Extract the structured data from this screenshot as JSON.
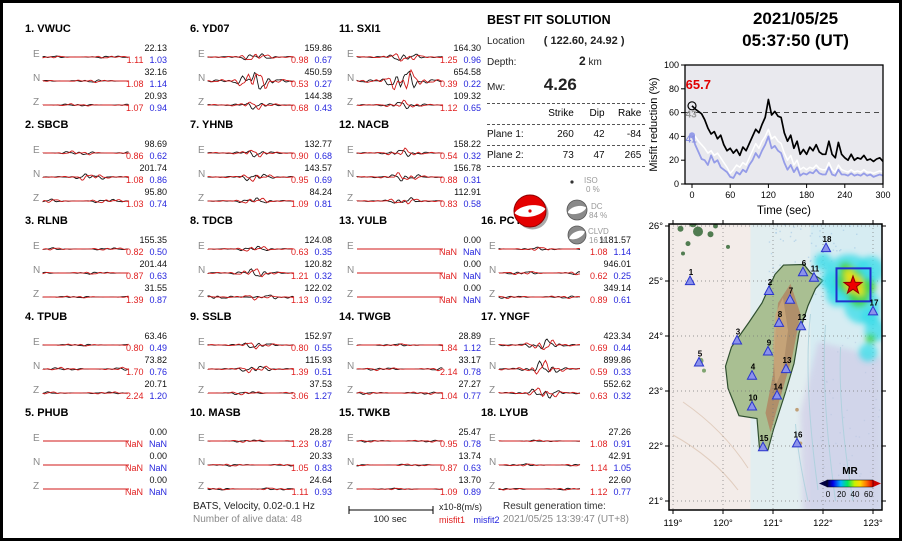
{
  "header": {
    "date": "2021/05/25",
    "time": "05:37:50  (UT)"
  },
  "solution": {
    "title": "BEST FIT SOLUTION",
    "location_label": "Location",
    "location_value": "( 122.60,  24.92 )",
    "depth_label": "Depth:",
    "depth_value": "2",
    "depth_unit": "km",
    "mw_label": "Mw:",
    "mw_value": "4.26",
    "table": {
      "headers": [
        "Strike",
        "Dip",
        "Rake"
      ],
      "rows": [
        {
          "label": "Plane 1:",
          "strike": "260",
          "dip": "42",
          "rake": "-84"
        },
        {
          "label": "Plane 2:",
          "strike": "73",
          "dip": "47",
          "rake": "265"
        }
      ]
    },
    "components": [
      {
        "name": "ISO",
        "pct": "0 %"
      },
      {
        "name": "DC",
        "pct": "84 %"
      },
      {
        "name": "CLVD",
        "pct": "16 %"
      }
    ]
  },
  "stations": [
    {
      "num": "1",
      "name": "VWUC",
      "channels": [
        {
          "c": "E",
          "amp": "22.13",
          "m1": "1.11",
          "m2": "1.03",
          "a": 1.0
        },
        {
          "c": "N",
          "amp": "32.16",
          "m1": "1.08",
          "m2": "1.14",
          "a": 1.2
        },
        {
          "c": "Z",
          "amp": "20.93",
          "m1": "1.07",
          "m2": "0.94",
          "a": 1.0
        }
      ]
    },
    {
      "num": "2",
      "name": "SBCB",
      "channels": [
        {
          "c": "E",
          "amp": "98.69",
          "m1": "0.86",
          "m2": "0.62",
          "a": 1.7
        },
        {
          "c": "N",
          "amp": "201.74",
          "m1": "1.08",
          "m2": "0.86",
          "a": 2.6
        },
        {
          "c": "Z",
          "amp": "95.80",
          "m1": "1.03",
          "m2": "0.74",
          "a": 1.6
        }
      ]
    },
    {
      "num": "3",
      "name": "RLNB",
      "channels": [
        {
          "c": "E",
          "amp": "155.35",
          "m1": "0.82",
          "m2": "0.50",
          "a": 1.0
        },
        {
          "c": "N",
          "amp": "201.44",
          "m1": "0.87",
          "m2": "0.63",
          "a": 1.0
        },
        {
          "c": "Z",
          "amp": "31.55",
          "m1": "1.39",
          "m2": "0.87",
          "a": 0.8
        }
      ]
    },
    {
      "num": "4",
      "name": "TPUB",
      "channels": [
        {
          "c": "E",
          "amp": "63.46",
          "m1": "0.80",
          "m2": "0.49",
          "a": 0.9
        },
        {
          "c": "N",
          "amp": "73.82",
          "m1": "1.70",
          "m2": "0.76",
          "a": 1.2
        },
        {
          "c": "Z",
          "amp": "20.71",
          "m1": "2.24",
          "m2": "1.20",
          "a": 0.9
        }
      ]
    },
    {
      "num": "5",
      "name": "PHUB",
      "channels": [
        {
          "c": "E",
          "amp": "0.00",
          "m1": "NaN",
          "m2": "NaN",
          "a": 0
        },
        {
          "c": "N",
          "amp": "0.00",
          "m1": "NaN",
          "m2": "NaN",
          "a": 0
        },
        {
          "c": "Z",
          "amp": "0.00",
          "m1": "NaN",
          "m2": "NaN",
          "a": 0
        }
      ]
    },
    {
      "num": "6",
      "name": "YD07",
      "channels": [
        {
          "c": "E",
          "amp": "159.86",
          "m1": "0.98",
          "m2": "0.67",
          "a": 3.0
        },
        {
          "c": "N",
          "amp": "450.59",
          "m1": "0.53",
          "m2": "0.27",
          "a": 8.0
        },
        {
          "c": "Z",
          "amp": "144.38",
          "m1": "0.68",
          "m2": "0.43",
          "a": 3.0
        }
      ]
    },
    {
      "num": "7",
      "name": "YHNB",
      "channels": [
        {
          "c": "E",
          "amp": "132.77",
          "m1": "0.90",
          "m2": "0.68",
          "a": 2.8
        },
        {
          "c": "N",
          "amp": "143.57",
          "m1": "0.95",
          "m2": "0.69",
          "a": 3.0
        },
        {
          "c": "Z",
          "amp": "84.24",
          "m1": "1.09",
          "m2": "0.81",
          "a": 2.4
        }
      ]
    },
    {
      "num": "8",
      "name": "TDCB",
      "channels": [
        {
          "c": "E",
          "amp": "124.08",
          "m1": "0.63",
          "m2": "0.35",
          "a": 2.2
        },
        {
          "c": "N",
          "amp": "120.82",
          "m1": "1.21",
          "m2": "0.32",
          "a": 3.5
        },
        {
          "c": "Z",
          "amp": "122.02",
          "m1": "1.13",
          "m2": "0.92",
          "a": 2.0
        }
      ]
    },
    {
      "num": "9",
      "name": "SSLB",
      "channels": [
        {
          "c": "E",
          "amp": "152.97",
          "m1": "0.80",
          "m2": "0.55",
          "a": 2.6
        },
        {
          "c": "N",
          "amp": "115.93",
          "m1": "1.39",
          "m2": "0.51",
          "a": 2.8
        },
        {
          "c": "Z",
          "amp": "37.53",
          "m1": "3.06",
          "m2": "1.27",
          "a": 1.4
        }
      ]
    },
    {
      "num": "10",
      "name": "MASB",
      "channels": [
        {
          "c": "E",
          "amp": "28.28",
          "m1": "1.23",
          "m2": "0.87",
          "a": 1.0
        },
        {
          "c": "N",
          "amp": "20.33",
          "m1": "1.05",
          "m2": "0.83",
          "a": 0.9
        },
        {
          "c": "Z",
          "amp": "24.64",
          "m1": "1.11",
          "m2": "0.93",
          "a": 1.0
        }
      ]
    },
    {
      "num": "11",
      "name": "SXI1",
      "channels": [
        {
          "c": "E",
          "amp": "164.30",
          "m1": "1.25",
          "m2": "0.96",
          "a": 3.5
        },
        {
          "c": "N",
          "amp": "654.58",
          "m1": "0.39",
          "m2": "0.22",
          "a": 9.0
        },
        {
          "c": "Z",
          "amp": "109.32",
          "m1": "1.12",
          "m2": "0.65",
          "a": 3.0
        }
      ]
    },
    {
      "num": "12",
      "name": "NACB",
      "channels": [
        {
          "c": "E",
          "amp": "158.22",
          "m1": "0.54",
          "m2": "0.32",
          "a": 3.0
        },
        {
          "c": "N",
          "amp": "156.78",
          "m1": "0.88",
          "m2": "0.31",
          "a": 3.2
        },
        {
          "c": "Z",
          "amp": "112.91",
          "m1": "0.83",
          "m2": "0.58",
          "a": 2.6
        }
      ]
    },
    {
      "num": "13",
      "name": "YULB",
      "channels": [
        {
          "c": "E",
          "amp": "0.00",
          "m1": "NaN",
          "m2": "NaN",
          "a": 0
        },
        {
          "c": "N",
          "amp": "0.00",
          "m1": "NaN",
          "m2": "NaN",
          "a": 0
        },
        {
          "c": "Z",
          "amp": "0.00",
          "m1": "NaN",
          "m2": "NaN",
          "a": 0
        }
      ]
    },
    {
      "num": "14",
      "name": "TWGB",
      "channels": [
        {
          "c": "E",
          "amp": "28.89",
          "m1": "1.84",
          "m2": "1.12",
          "a": 1.0
        },
        {
          "c": "N",
          "amp": "33.17",
          "m1": "2.14",
          "m2": "0.78",
          "a": 1.2
        },
        {
          "c": "Z",
          "amp": "27.27",
          "m1": "1.04",
          "m2": "0.77",
          "a": 1.0
        }
      ]
    },
    {
      "num": "15",
      "name": "TWKB",
      "channels": [
        {
          "c": "E",
          "amp": "25.47",
          "m1": "0.95",
          "m2": "0.78",
          "a": 0.8
        },
        {
          "c": "N",
          "amp": "13.74",
          "m1": "0.87",
          "m2": "0.63",
          "a": 0.8
        },
        {
          "c": "Z",
          "amp": "13.70",
          "m1": "1.09",
          "m2": "0.89",
          "a": 0.7
        }
      ]
    },
    {
      "num": "16",
      "name": "PCYB",
      "channels": [
        {
          "c": "E",
          "amp": "1181.57",
          "m1": "1.08",
          "m2": "1.14",
          "a": 1.5
        },
        {
          "c": "N",
          "amp": "946.01",
          "m1": "0.62",
          "m2": "0.25",
          "a": 1.5
        },
        {
          "c": "Z",
          "amp": "349.14",
          "m1": "0.89",
          "m2": "0.61",
          "a": 1.1
        }
      ]
    },
    {
      "num": "17",
      "name": "YNGF",
      "channels": [
        {
          "c": "E",
          "amp": "423.34",
          "m1": "0.69",
          "m2": "0.44",
          "a": 4.5
        },
        {
          "c": "N",
          "amp": "899.86",
          "m1": "0.59",
          "m2": "0.33",
          "a": 5.5
        },
        {
          "c": "Z",
          "amp": "552.62",
          "m1": "0.63",
          "m2": "0.32",
          "a": 4.5
        }
      ]
    },
    {
      "num": "18",
      "name": "LYUB",
      "channels": [
        {
          "c": "E",
          "amp": "27.26",
          "m1": "1.08",
          "m2": "0.91",
          "a": 0.7
        },
        {
          "c": "N",
          "amp": "42.91",
          "m1": "1.14",
          "m2": "1.05",
          "a": 1.0
        },
        {
          "c": "Z",
          "amp": "22.60",
          "m1": "1.12",
          "m2": "0.77",
          "a": 0.8
        }
      ]
    }
  ],
  "footer": {
    "info1": "BATS, Velocity, 0.02-0.1 Hz",
    "info2": "Number of alive data: 48",
    "scale_label": "100 sec",
    "unit_label": "x10-8(m/s)",
    "legend1": "misfit1",
    "legend2": "misfit2",
    "result_label": "Result generation time:",
    "result_time": "2021/05/25 13:39:47 (UT+8)"
  },
  "chart_data": [
    {
      "type": "line",
      "title": "Misfit reduction vs time",
      "xlabel": "Time (sec)",
      "ylabel": "Misfit reduction (%)",
      "xlim": [
        -11,
        300
      ],
      "ylim": [
        0,
        100
      ],
      "xticks": [
        0,
        60,
        120,
        180,
        240,
        300
      ],
      "yticks": [
        0,
        20,
        40,
        60,
        80,
        100
      ],
      "dashed_line_y": 60,
      "x_step": 5,
      "series": [
        {
          "name": "best-misfit-reduction",
          "color": "#000000",
          "width": 1.7,
          "values": [
            65.7,
            63,
            61,
            59,
            54,
            47,
            42,
            44,
            38,
            41,
            33,
            28,
            30,
            26,
            29,
            24,
            31,
            28,
            34,
            40,
            46,
            43,
            50,
            56,
            71,
            58,
            61,
            57,
            56,
            43,
            36,
            41,
            30,
            36,
            25,
            29,
            25,
            31,
            28,
            33,
            27,
            25,
            25,
            36,
            25,
            22,
            35,
            25,
            22,
            20,
            25,
            20,
            22,
            21,
            24,
            20,
            21,
            19,
            21,
            22,
            19
          ]
        },
        {
          "name": "mid-misfit-reduction",
          "color": "#ffffff",
          "width": 1.5,
          "values": [
            43,
            40,
            36,
            33,
            30,
            26,
            28,
            24,
            26,
            22,
            18,
            14,
            9,
            12,
            16,
            14,
            18,
            16,
            22,
            28,
            34,
            30,
            36,
            40,
            46,
            38,
            40,
            36,
            34,
            26,
            20,
            24,
            16,
            20,
            12,
            14,
            12,
            14,
            13,
            16,
            13,
            12,
            12,
            18,
            12,
            10,
            16,
            12,
            11,
            10,
            12,
            10,
            11,
            10,
            12,
            10,
            10,
            9,
            10,
            11,
            10
          ]
        },
        {
          "name": "low-misfit-reduction",
          "color": "#959ce8",
          "width": 1.8,
          "values": [
            41,
            33,
            27,
            21,
            20,
            16,
            24,
            18,
            20,
            14,
            12,
            10,
            6,
            5,
            10,
            8,
            12,
            10,
            16,
            20,
            26,
            22,
            28,
            33,
            40,
            30,
            32,
            28,
            26,
            18,
            12,
            16,
            10,
            14,
            7,
            9,
            8,
            10,
            9,
            12,
            9,
            8,
            8,
            14,
            8,
            7,
            12,
            8,
            8,
            7,
            9,
            7,
            8,
            7,
            9,
            7,
            8,
            6,
            7,
            8,
            7
          ]
        }
      ],
      "annotations": [
        {
          "text": "65.7",
          "color": "#e00000",
          "y": 80,
          "bold": true,
          "size": 13
        },
        {
          "text": "43",
          "color": "#9a9a9a",
          "y": 56,
          "bold": true,
          "size": 10
        },
        {
          "text": "41",
          "color": "#8890e0",
          "y": 35,
          "bold": true,
          "size": 10
        }
      ],
      "plot_bg": "#e9e9ee"
    },
    {
      "type": "map",
      "lon_range": [
        119,
        123
      ],
      "lat_range": [
        21,
        26
      ],
      "xtick_labels": [
        "119°",
        "120°",
        "121°",
        "122°",
        "123°"
      ],
      "ytick_labels": [
        "26°",
        "25°",
        "24°",
        "23°",
        "22°",
        "21°"
      ],
      "epicenter": {
        "lon": 122.6,
        "lat": 24.92
      },
      "inversion_box": {
        "lon": [
          122.27,
          122.95
        ],
        "lat": [
          24.63,
          25.23
        ]
      },
      "stations": [
        {
          "num": "1",
          "lon": 119.34,
          "lat": 25.0
        },
        {
          "num": "2",
          "lon": 120.92,
          "lat": 24.82
        },
        {
          "num": "3",
          "lon": 120.28,
          "lat": 23.92
        },
        {
          "num": "4",
          "lon": 120.58,
          "lat": 23.28
        },
        {
          "num": "5",
          "lon": 119.52,
          "lat": 23.52
        },
        {
          "num": "6",
          "lon": 121.6,
          "lat": 25.16
        },
        {
          "num": "7",
          "lon": 121.34,
          "lat": 24.66
        },
        {
          "num": "8",
          "lon": 121.12,
          "lat": 24.24
        },
        {
          "num": "9",
          "lon": 120.9,
          "lat": 23.72
        },
        {
          "num": "10",
          "lon": 120.58,
          "lat": 22.72
        },
        {
          "num": "11",
          "lon": 121.82,
          "lat": 25.06
        },
        {
          "num": "12",
          "lon": 121.56,
          "lat": 24.18
        },
        {
          "num": "13",
          "lon": 121.26,
          "lat": 23.4
        },
        {
          "num": "14",
          "lon": 121.08,
          "lat": 22.92
        },
        {
          "num": "15",
          "lon": 120.8,
          "lat": 21.98
        },
        {
          "num": "16",
          "lon": 121.48,
          "lat": 22.05
        },
        {
          "num": "17",
          "lon": 123.0,
          "lat": 24.45
        },
        {
          "num": "18",
          "lon": 122.06,
          "lat": 25.6
        }
      ],
      "colorbar": {
        "label": "MR",
        "ticks": [
          "0",
          "20",
          "40",
          "60"
        ]
      }
    }
  ]
}
